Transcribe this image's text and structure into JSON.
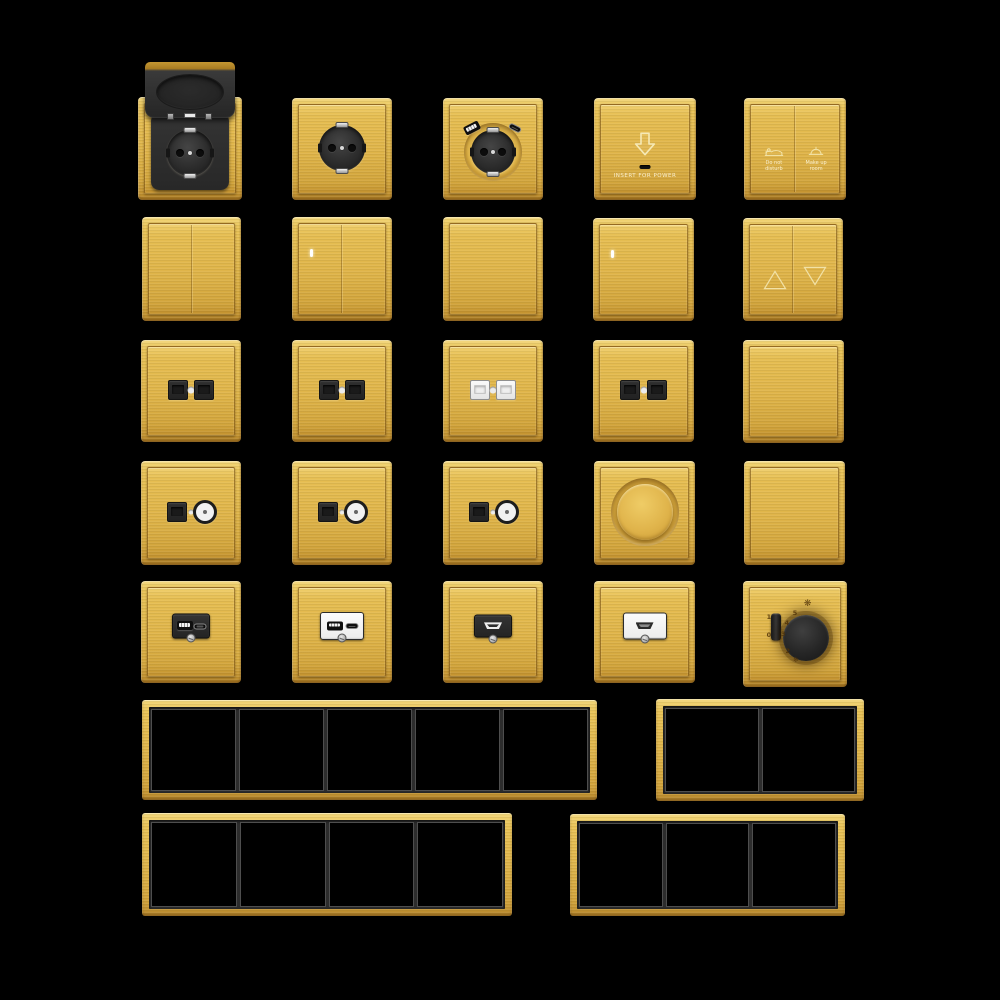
{
  "background": "#000000",
  "palette": {
    "gold_highlight": "#F2D678",
    "gold_base": "#E0B74C",
    "gold_shadow": "#A9781F",
    "module_black": "#2B2B2B",
    "module_white": "#F3F3F3",
    "frame_inner_gray": "#2D2D2D",
    "frame_slot_black": "#000000",
    "metal_silver": "#D9D9D9"
  },
  "labels": {
    "key_card_text": "INSERT FOR POWER",
    "dnd_line1": "Do not",
    "dnd_line2": "disturb",
    "mur_line1": "Make up",
    "mur_line2": "room",
    "thermo_on": "1",
    "thermo_off": "0",
    "thermo_dial": [
      "2",
      "3",
      "4",
      "5"
    ],
    "thermo_cool_icon": "❄",
    "thermo_fan_icon": "❋"
  },
  "items": [
    {
      "type": "socket-flip",
      "name": "socket-schuko-flip-cover",
      "x": 138,
      "y": 97,
      "w": 104,
      "h": 103
    },
    {
      "type": "socket-schuko",
      "name": "socket-schuko",
      "x": 292,
      "y": 98,
      "w": 100,
      "h": 102
    },
    {
      "type": "socket-usb",
      "name": "socket-schuko-usb",
      "x": 443,
      "y": 98,
      "w": 100,
      "h": 102
    },
    {
      "type": "key-card",
      "name": "key-card-power-switch",
      "x": 594,
      "y": 98,
      "w": 102,
      "h": 102
    },
    {
      "type": "switch-dnd",
      "name": "switch-dnd-mur",
      "x": 744,
      "y": 98,
      "w": 102,
      "h": 102
    },
    {
      "type": "switch-2g",
      "name": "switch-2gang",
      "x": 142,
      "y": 217,
      "w": 99,
      "h": 104
    },
    {
      "type": "switch-2g",
      "name": "switch-2gang-led",
      "led": true,
      "x": 292,
      "y": 217,
      "w": 100,
      "h": 104
    },
    {
      "type": "switch-1g",
      "name": "switch-1gang",
      "x": 443,
      "y": 217,
      "w": 100,
      "h": 104
    },
    {
      "type": "switch-1g",
      "name": "switch-1gang-led",
      "led": true,
      "x": 593,
      "y": 218,
      "w": 101,
      "h": 103
    },
    {
      "type": "switch-curtain",
      "name": "switch-curtain",
      "x": 743,
      "y": 218,
      "w": 100,
      "h": 103
    },
    {
      "type": "jack-double",
      "name": "socket-data-double-black",
      "jack": "black",
      "x": 141,
      "y": 340,
      "w": 100,
      "h": 102
    },
    {
      "type": "jack-double",
      "name": "socket-data-double-black",
      "jack": "black",
      "x": 292,
      "y": 340,
      "w": 100,
      "h": 102
    },
    {
      "type": "jack-double",
      "name": "socket-data-double-white",
      "jack": "white",
      "x": 443,
      "y": 340,
      "w": 100,
      "h": 102
    },
    {
      "type": "jack-double",
      "name": "socket-data-double-black",
      "jack": "black",
      "x": 593,
      "y": 340,
      "w": 101,
      "h": 102
    },
    {
      "type": "blank",
      "name": "blank-plate",
      "x": 743,
      "y": 340,
      "w": 101,
      "h": 103
    },
    {
      "type": "jack-tv",
      "name": "socket-data-tv",
      "x": 141,
      "y": 461,
      "w": 100,
      "h": 104
    },
    {
      "type": "jack-tv",
      "name": "socket-data-tv",
      "x": 292,
      "y": 461,
      "w": 100,
      "h": 104
    },
    {
      "type": "jack-tv",
      "name": "socket-data-tv",
      "x": 443,
      "y": 461,
      "w": 100,
      "h": 104
    },
    {
      "type": "dimmer",
      "name": "dimmer-rotary",
      "x": 594,
      "y": 461,
      "w": 101,
      "h": 104
    },
    {
      "type": "blank",
      "name": "blank-plate",
      "x": 744,
      "y": 461,
      "w": 101,
      "h": 104
    },
    {
      "type": "usb-module",
      "name": "usb-charger-black",
      "variant": "black",
      "x": 141,
      "y": 581,
      "w": 100,
      "h": 102
    },
    {
      "type": "usb-module",
      "name": "usb-charger-white",
      "variant": "white",
      "x": 292,
      "y": 581,
      "w": 100,
      "h": 102
    },
    {
      "type": "hdmi-module",
      "name": "hdmi-outlet-black",
      "variant": "black",
      "x": 443,
      "y": 581,
      "w": 100,
      "h": 102
    },
    {
      "type": "hdmi-module",
      "name": "hdmi-outlet-white",
      "variant": "white",
      "x": 594,
      "y": 581,
      "w": 101,
      "h": 102
    },
    {
      "type": "thermostat",
      "name": "fan-speed-controller",
      "x": 743,
      "y": 581,
      "w": 104,
      "h": 106
    },
    {
      "type": "frame",
      "name": "frame-5gang",
      "cells": 5,
      "x": 142,
      "y": 700,
      "w": 455,
      "h": 100
    },
    {
      "type": "frame",
      "name": "frame-2gang",
      "cells": 2,
      "x": 656,
      "y": 699,
      "w": 208,
      "h": 102
    },
    {
      "type": "frame",
      "name": "frame-4gang",
      "cells": 4,
      "x": 142,
      "y": 813,
      "w": 370,
      "h": 103
    },
    {
      "type": "frame",
      "name": "frame-3gang",
      "cells": 3,
      "x": 570,
      "y": 814,
      "w": 275,
      "h": 102
    }
  ]
}
